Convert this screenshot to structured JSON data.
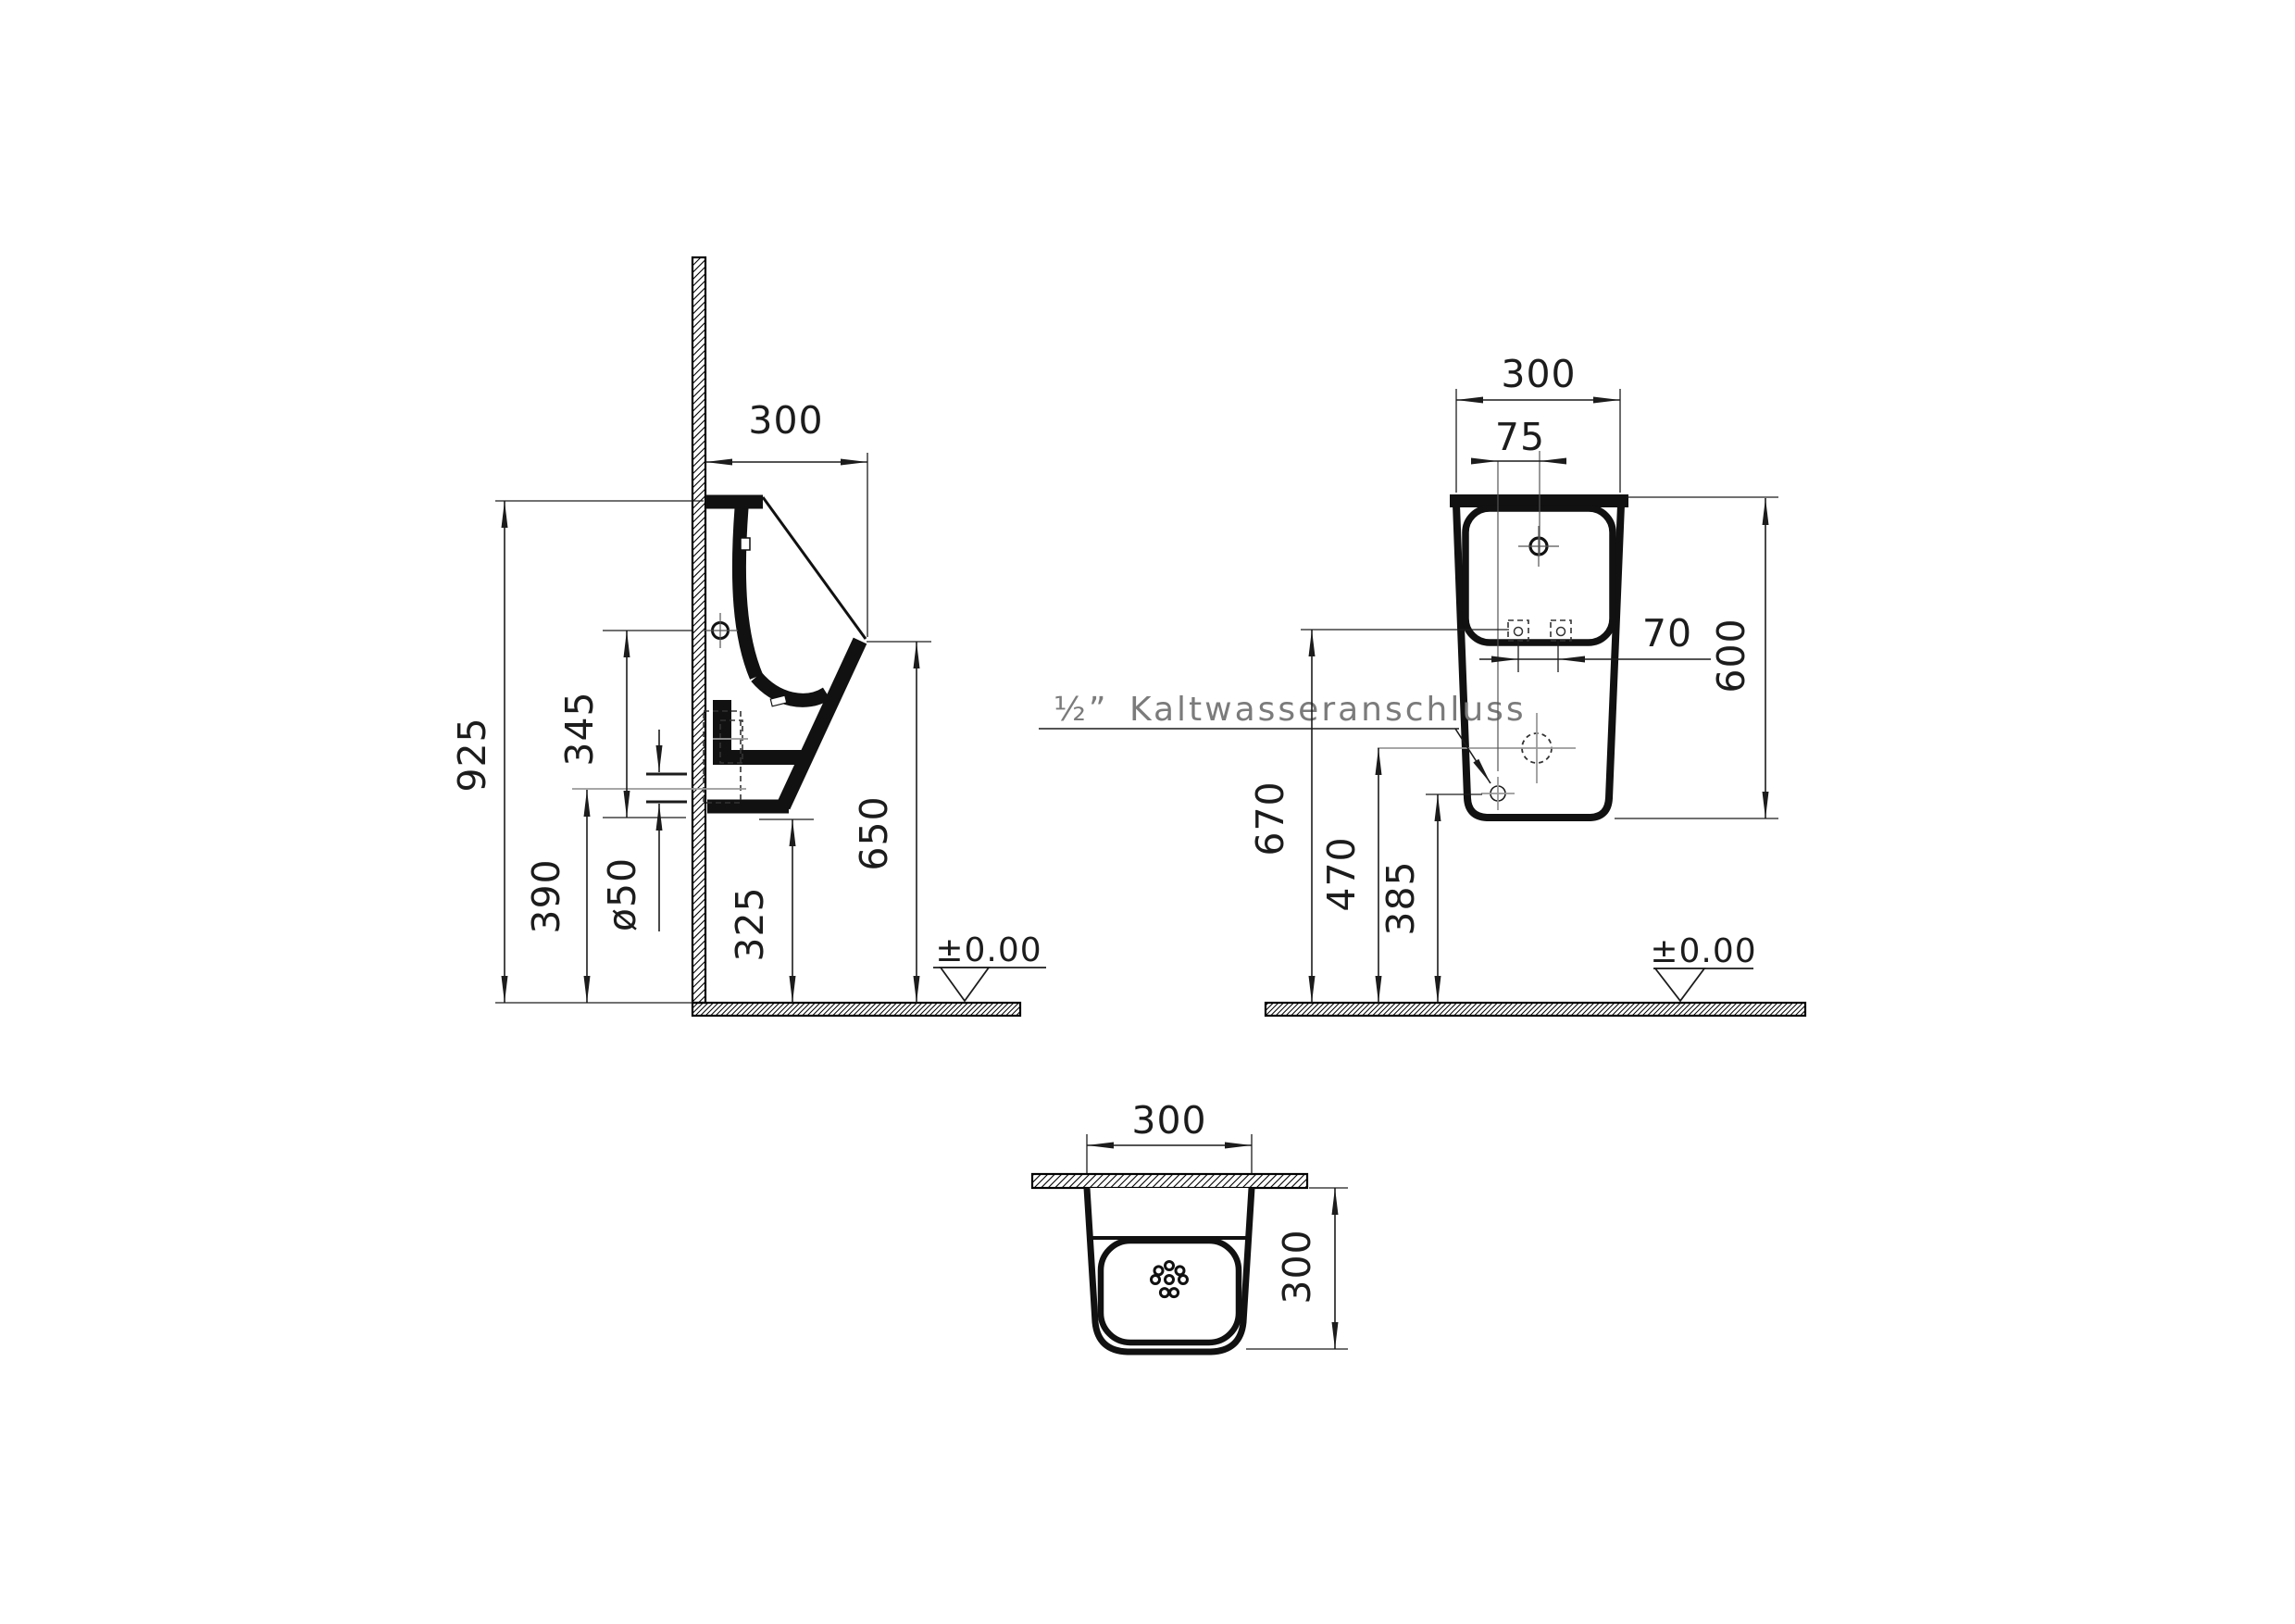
{
  "side_view": {
    "depth": "300",
    "total_height": "925",
    "bottom_to_holes": "345",
    "outlet_height": "390",
    "outlet_diameter": "ø50",
    "bottom_height": "325",
    "spout_height": "650",
    "floor_level": "±0.00"
  },
  "front_view": {
    "width": "300",
    "inlet_offset": "75",
    "bolt_spacing": "70",
    "body_height": "600",
    "bolt_height": "670",
    "inlet_height": "470",
    "connection_height": "385",
    "connection_size": "½”",
    "connection_label": "Kaltwasseranschluss",
    "floor_level": "±0.00"
  },
  "top_view": {
    "width": "300",
    "depth": "300"
  }
}
